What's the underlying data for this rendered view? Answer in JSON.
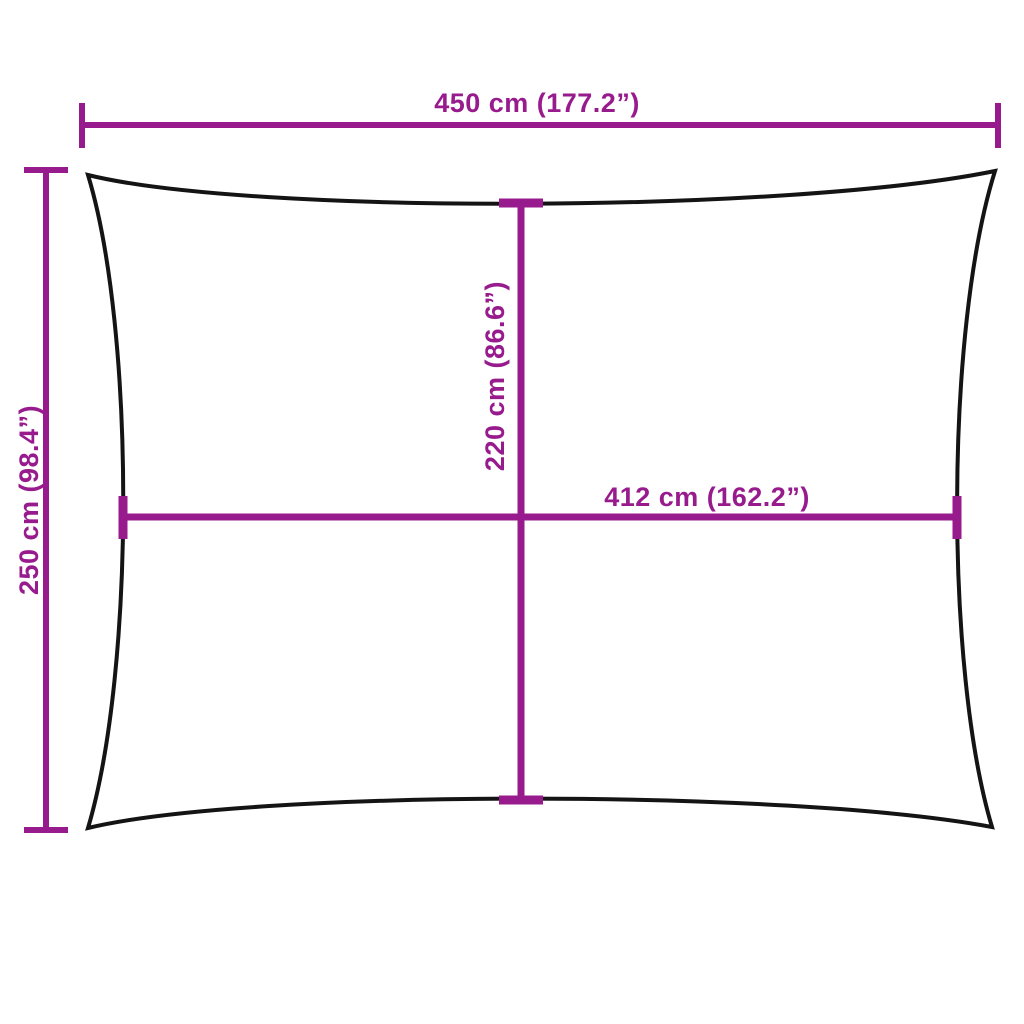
{
  "diagram": {
    "kind": "shade-sail-dimension-diagram",
    "labels": {
      "total_width": "450 cm (177.2”)",
      "total_height": "250 cm (98.4”)",
      "inner_height": "220 cm (86.6”)",
      "inner_width": "412 cm (162.2”)"
    },
    "dimensions": {
      "total_width_cm": 450,
      "total_width_in": 177.2,
      "total_height_cm": 250,
      "total_height_in": 98.4,
      "inner_width_cm": 412,
      "inner_width_in": 162.2,
      "inner_height_cm": 220,
      "inner_height_in": 86.6
    },
    "colors": {
      "dimension": "#981b8d",
      "outline": "#141414",
      "background": "#ffffff"
    }
  }
}
